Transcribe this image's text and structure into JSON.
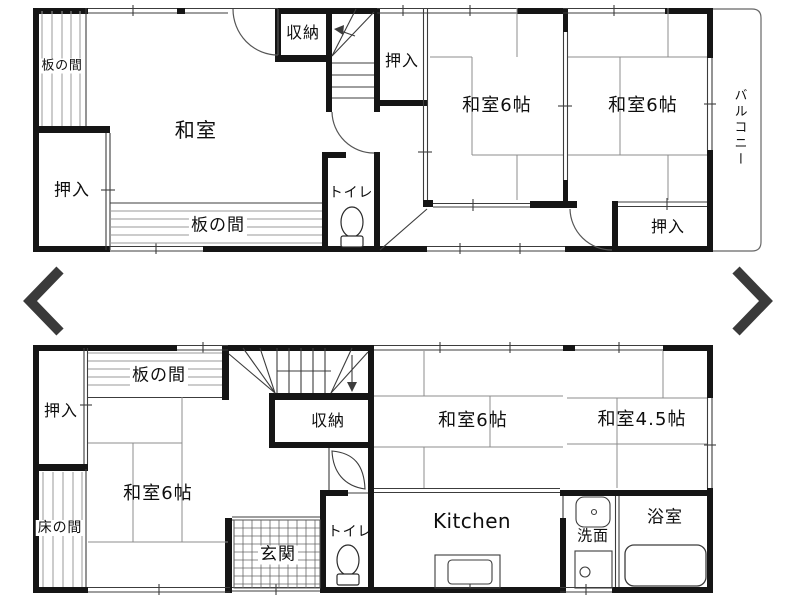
{
  "viewer": {
    "nav": {
      "prev_label": "previous image",
      "next_label": "next image"
    }
  },
  "colors": {
    "wall": "#151515",
    "thin_line": "#3c3c3c",
    "tatami_line": "#8c8c8c",
    "hatch_line": "#9a9a9a",
    "arrow": "#3a3a3a",
    "background": "#ffffff"
  },
  "floors": {
    "upper": {
      "rooms": [
        {
          "id": "itanoma-left",
          "label": "板の間"
        },
        {
          "id": "oshiire-left",
          "label": "押入"
        },
        {
          "id": "washitsu-main",
          "label": "和室"
        },
        {
          "id": "itanoma-bottom",
          "label": "板の間"
        },
        {
          "id": "shuno",
          "label": "収納"
        },
        {
          "id": "oshiire-top",
          "label": "押入"
        },
        {
          "id": "toilet",
          "label": "トイレ"
        },
        {
          "id": "washitsu6-left",
          "label": "和室6帖"
        },
        {
          "id": "washitsu6-right",
          "label": "和室6帖"
        },
        {
          "id": "oshiire-right",
          "label": "押入"
        },
        {
          "id": "balcony",
          "label": "バルコニー"
        }
      ]
    },
    "lower": {
      "rooms": [
        {
          "id": "oshiire",
          "label": "押入"
        },
        {
          "id": "itanoma",
          "label": "板の間"
        },
        {
          "id": "washitsu6-left",
          "label": "和室6帖"
        },
        {
          "id": "tokonoma",
          "label": "床の間"
        },
        {
          "id": "genkan",
          "label": "玄関"
        },
        {
          "id": "shuno",
          "label": "収納"
        },
        {
          "id": "toilet",
          "label": "トイレ"
        },
        {
          "id": "washitsu6-mid",
          "label": "和室6帖"
        },
        {
          "id": "kitchen",
          "label": "Kitchen"
        },
        {
          "id": "washitsu45",
          "label": "和室4.5帖"
        },
        {
          "id": "senmen",
          "label": "洗面"
        },
        {
          "id": "bathroom",
          "label": "浴室"
        }
      ]
    }
  }
}
